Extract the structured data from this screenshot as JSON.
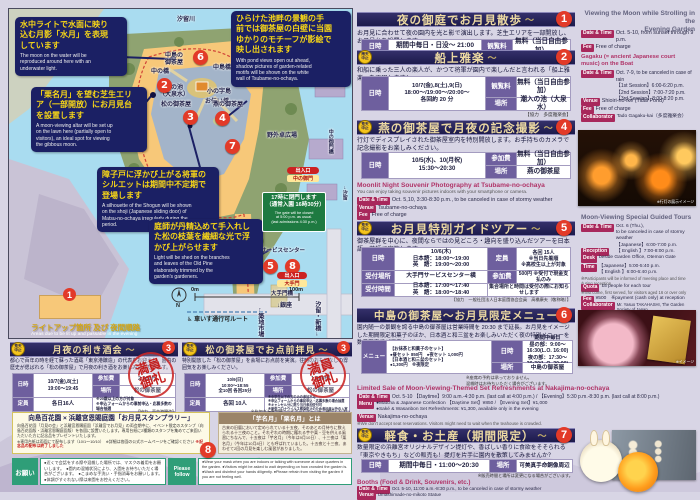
{
  "misc": {
    "stamp1": "満員",
    "stamp2": "御礼",
    "rain1": "雨天",
    "storm1": "荒天",
    "chu": "中止",
    "swirl": "～"
  },
  "L": {
    "date": "日時",
    "fee": "観覧料",
    "join": "参加費",
    "place": "場所",
    "quota": "定員",
    "rec_place": "受付場所",
    "rec_time": "受付時間",
    "menu": "メニュー",
    "date_en": "Date & Time",
    "fee_en": "Fee",
    "venue_en": "Venue",
    "collab_en": "Collaborator",
    "menu_en": "Menu",
    "reception_en": "Reception",
    "desk_en": "Desk",
    "time_en": "Time",
    "quota_en": "Quota"
  },
  "map": {
    "river_top": "汐留川",
    "markers": [
      "2",
      "3",
      "4",
      "5",
      "6",
      "7",
      "8"
    ],
    "callouts": [
      {
        "jp": "水中ライトで水面に映り\n込む月影「水月」を表現\nしています",
        "en": "The moon on the water will be\nreproduced around here with an\nunderwater light."
      },
      {
        "jp": "「栗名月」を望む芝生エリ\nア（一部開放）にお月見台\nを設置します",
        "en": "A moon-viewing altar will be set up\non the lawn here (partially open to\nvisitors), an ideal spot for viewing\nthe gibbous moon."
      },
      {
        "jp": "ひらけた池畔の景観の手\n前では御茶屋の白壁に当園\nゆかりのモチーフが影絵で\n映し出されます",
        "en": "With pond views open out ahead,\nshadow pictures of garden-related\nmotifs will be shown on the white\nwall of Tsubame-no-ochaya."
      },
      {
        "jp": "障子戸に浮かび上がる将軍の\nシルエットは期間中不定期で\n登場します",
        "en": "A silhouette of the Shogun will be shown\non the shoji (Japanese sliding door) of\nMatsu-no-ochaya irregularly during the\nperiod."
      },
      {
        "jp": "庭師が丹精込めて手入れし\nた松の枝葉を繊細な光で浮\nかび上がらせます",
        "en": "Light will be shed on the branches\nand leaves of the Old Pine\nelaborately trimmed by the\ngarden's gardeners."
      }
    ],
    "labels": {
      "naka_bashi": "中の橋",
      "nakajima_ochaya": "中島の\n御茶屋",
      "nakajima_bashi": "中島橋",
      "pond": "潮入の池\n（大泉水）",
      "konoji": "小の字島",
      "otsutai": "お伝い橋",
      "matsu": "松の御茶屋",
      "tsubame": "燕の御茶屋",
      "yagai": "野外卓広場",
      "service": "サービスセンター",
      "sanbyaku": "三百年の松",
      "otemon_bashi": "大手門橋",
      "tsukiji_river": "築地川",
      "ginza": "↓銀座",
      "tsukiji": "←築地市場",
      "shiodome_shinbashi": "汐留・新橋→",
      "kyu_shiba": "↑旧芝離宮恩賜庭園・浜松町",
      "shiodome": "→汐留",
      "nakanogomon_bashi": "中の御門橋"
    },
    "gate": {
      "jp": "17時に閉門します\n（通常入園 16時30分）",
      "en": "The gate will be closed\nat 5:00 p.m. as usual.\n(last admissions 4:30 p.m.)"
    },
    "exit1": {
      "a": "出入口",
      "b": "中の御門"
    },
    "exit2": {
      "a": "出入口",
      "b": "大手門"
    },
    "legend": {
      "num": "1",
      "jp": "ライトアップ箇所 及び 夜間順路",
      "en": "Areas due to be lit up and passable in the evening"
    },
    "scale0": "0m",
    "scale100": "100m",
    "compass": "N",
    "wheel": "車いす通行可ルート"
  },
  "p1": {
    "num": "1",
    "title": "夜の御庭でお月見散歩",
    "desc": "お月見に合わせて夜の園内を光と影で演出します。芝生エリアを一部開放し、お月見台を設置します。",
    "date": "期間中毎日・日没〜 21:00",
    "fee": "無料（当日自由参加）",
    "en": {
      "title": "Viewing the Moon while Strolling in the\nEvening Garden",
      "date": "Oct. 5-10, from sunset through 9 p.m.",
      "fee": "Free of charge"
    }
  },
  "p2": {
    "num": "2",
    "title": "船上雅楽",
    "desc": "和船に乗った三人の楽人が、かつて将軍が園内で楽しんだと言われる「船上雅楽」を再現します！",
    "date": "10/7(金),8(土),9(日)\n18:00〜/19:00〜/20:00〜\n各回約 20 分",
    "fee": "無料（当日自由参加）",
    "place": "潮入の池（大泉水）",
    "note": "【協力　多度雅楽会】",
    "en": {
      "title": "Gagaku (= ancient Japanese court music) on the Boat",
      "date": "Oct. 7-9, to be canceled in case of rain\n【1st Session】6:00-6:20 p.m.\n【2nd Session】7:00-7:20 p.m.\n【3rd Session】8:00-8:20 p.m.",
      "venue": "Shioiri-no-ike (Tidal Pond)",
      "fee": "Free of charge",
      "collab": "Tado Gagaku-kai（多度雅楽会）"
    }
  },
  "p3": {
    "num": "4",
    "title": "燕の御茶屋で月夜の記念撮影",
    "desc": "行灯でディスプレイされた御茶屋室内を特別開放します。お手持ちのカメラで記念撮影をお楽しみください。",
    "date": "10/5(水)、10(月祝)\n15:30〜20:30",
    "fee": "無料（当日自由参加）",
    "place": "燕の御茶屋",
    "en": {
      "title": "Moonlit Night Souvenir Photography at Tsubame-no-ochaya",
      "sub": "You can enjoy taking souvenir pictures indoors with your smartphone or camera.",
      "date": "Oct. 5,10, 3:30-8:30 p.m., to be canceled in case of stormy weather",
      "venue": "Tsubame-no-ochaya",
      "fee": "Free of charge"
    },
    "photo_cap": "※行灯の展示イメージ"
  },
  "p4": {
    "num": "5",
    "title": "お月見特別ガイドツアー",
    "desc": "御茶屋群を中心に、夜間ならではの見どころ・趣向を盛り込んだツアーを日本語・英語で実施します。",
    "date": "10/6(木)\n日本語：18:00〜19:00\n英　語：19:00〜20:00",
    "quota": "各回 15人\n※当日先着順\n※高校生以上が対象",
    "rec_place": "大手門サービスセンター横",
    "join": "500円 ※受付で現金支払のみ",
    "rec_time": "日本語：17:00〜17:40\n英　語：18:00〜18:40",
    "meet_note": "集合場所と時間は受付の際にお知らせします",
    "note": "【協力　一般社団法人日本庭園協会会員　高橋康夫（敬称略）】",
    "en": {
      "title": "Moon-Viewing Special Guided Tours",
      "date": "Oct. 6 (Thu.),\nto be canceled in case of stormy weather\n【Japanese】6:00-7:00 p.m.\n【 English 】7:00-8:00 p.m.",
      "desk": "beside Garden Office, Otemon Gate",
      "time": "【Japanese】5:00-5:40 p.m.\n【 English 】6:00-6:40 p.m.",
      "note1": "※Participants will be informed of meeting place and time during reception.",
      "quota": "15 people for each tour",
      "note2": "※first come, first served, for visitors aged 16 or over only",
      "fee": "¥500　※payment (cash only) at reception",
      "collab": "Mr. Yasuo TAKAHASHI, The Garden Society of Japan"
    }
  },
  "p5": {
    "num": "6",
    "title": "中島の御茶屋〜お月見限定メニュー",
    "desc": "園内随一の景観を誇る中島の御茶屋は営業時間を 20:30 まで延長。お月見をイメージした期間限定和菓子のほか、日本酒と和三盆をお楽しみいただく夜の特別メニューを数量限定でご用意しました。",
    "date": "期間中毎日\n昼の部：9:00〜16:30(L.O. 16:00)\n夜の部：17:30〜20:30(L.O. 20:00)",
    "menu": "【お抹茶と和菓子のセット】\n●昼セット 850円　●夜セット 1,000円\n【日本酒と和三盆のセット】\n●1,300円　※夜限定",
    "place": "中島の御茶屋",
    "note": "※座席の予約は承っておりません。\n混雑時はお待ちいただく場合がございます。",
    "en": {
      "title": "Limited Sale of Moon-Viewing-Themed Set Refreshments at Nakajima-no-ochaya",
      "date": "Oct. 5-10 【Daytime】9:00 a.m.-4:30 p.m. (last call at 4:00 p.m.)  /  【Evening】5:30 p.m.-8:30 p.m. (last call at 8:00 p.m.)",
      "menu": "●Matcha & Japanese Confection 【Daytime Set】¥850 / 【Evening Set】¥1,000\n●Saké & Wasanbon Set Refreshments: ¥1,300, available only in the evening",
      "venue": "Nakajima-no-ochaya",
      "note": "※We don't accept seat reservations. Visitors might need to wait when the teahouse is crowded."
    },
    "photo_cap": "※イメージ"
  },
  "p6": {
    "num": "7",
    "title": "軽食・お土産（期間限定）",
    "desc": "数量限定の浜離宮オリジナルデザイン提灯や、香ばしい香りに食欲をそそられる「東京やきもち」などの販売も！提灯を片手に園内を散策してみませんか？",
    "date": "期間中毎日・11:00〜20:30",
    "place": "可美真手命銅像周辺",
    "note": "※販売時間と場所は変更になる場合がございます。",
    "en": {
      "title": "Booths (Food & Drink, Souvenirs, etc.)",
      "date": "Oct. 5-10, 11:00 a.m.-8:30 p.m., to be canceled in case of stormy weather",
      "venue": "Umashimade-no-mikoto Statue",
      "fee": "Free of charge",
      "note": "※venue might be changed and sale might be ended when stocks are gone"
    }
  },
  "b1": {
    "num": "3",
    "title": "月夜の利き酒会",
    "desc": "都心で百年の時を経て蘇った酒蔵「東京港醸造」の代表をお迎えし、園内の歴史が偲ばれる「松の御茶屋」で月夜の利き酒をお楽しみいただきます。",
    "date": "10/7(金),8(土)\n19:00〜19:45",
    "join": "2,000円",
    "place": "松の御茶屋",
    "quota": "各日16人",
    "notes": "※20歳以上の方が対象\n※申込フォームからの事前申込・応募多数の場合抽選",
    "note": "【協力　東京港醸造】"
  },
  "b2": {
    "num": "3",
    "title": "松の御茶屋でお点前拝見",
    "desc": "特別開放した「松の御茶屋」を会場にお点前を実演。往時のおもてなしの雰囲気をお楽しみください。",
    "date": "10/9(日)\n10:00〜18:55\n全10回 各回25分",
    "join": "1,500円",
    "place": "松の御茶屋",
    "quota": "各回 10人",
    "notes": "※中学生以下の方のみの参加不可\n※申込フォームからの事前申込・応募多数の場合抽選\n※キャンセル分に限り当日参加受付可\n※新型コロナウイルス感染防止のため参加者以外の入室不可",
    "note": "※参加申込の詳細は公式ホームページをご確認ください"
  },
  "rally": {
    "num": "8",
    "title": "向島百花園 × 浜離宮恩賜庭園「お月見スタンプラリー」",
    "body": "向島百花園「月見の会」と浜離宮恩賜庭園「浜離宮でお月見」の両会期中に、イベント限定のスタンプ（向島百花園版・浜離宮恩賜庭園版）を各園に設置いたします。専用台紙に2種類のスタンプを集めてご来園いただいた方に記念品をプレゼントいたします。",
    "notes": "※専用台紙は両園にて配布します（10/1〜10/10）　※詳細は各園の公式ホームページをご確認ください",
    "red_note": "※記念品の配布は終了しました"
  },
  "meigetsu": {
    "title": "「芋名月」「栗名月」とは",
    "body": "古来の旧暦において定められている十五夜、そのあとの月待ちに数えられる十三夜のこと。それぞれの時期に穫れる芋や栗・豆を供える風習にちなんで、十五夜は「芋名月」（今年は9月10日）、十三夜は「栗名月」（今年は10月8日）とも呼ばれていました。十五夜と十三夜、あわせて2回の月見を楽しむ風習がありました。"
  },
  "req": {
    "label": "お願い",
    "label_en": "Please\nfollow",
    "jp": "●近くで会話をする際や混雑した場所では、マスクの着用をお願いします。　●園内の混雑状況により、入園をお待ちいただく場合がございます。　●こまめな手洗い・手指消毒をお願いします。　●体調がすぐれない際は来園をお控えください。",
    "en": "●Wear your mask when you are indoors or talking with someone at close quarters in the garden.  ●Visitors might be asked to wait depending on how crowded the garden is.  ●Wash and disinfect your hands diligently.  ●Please refrain from visiting the garden if you are not feeling well."
  }
}
